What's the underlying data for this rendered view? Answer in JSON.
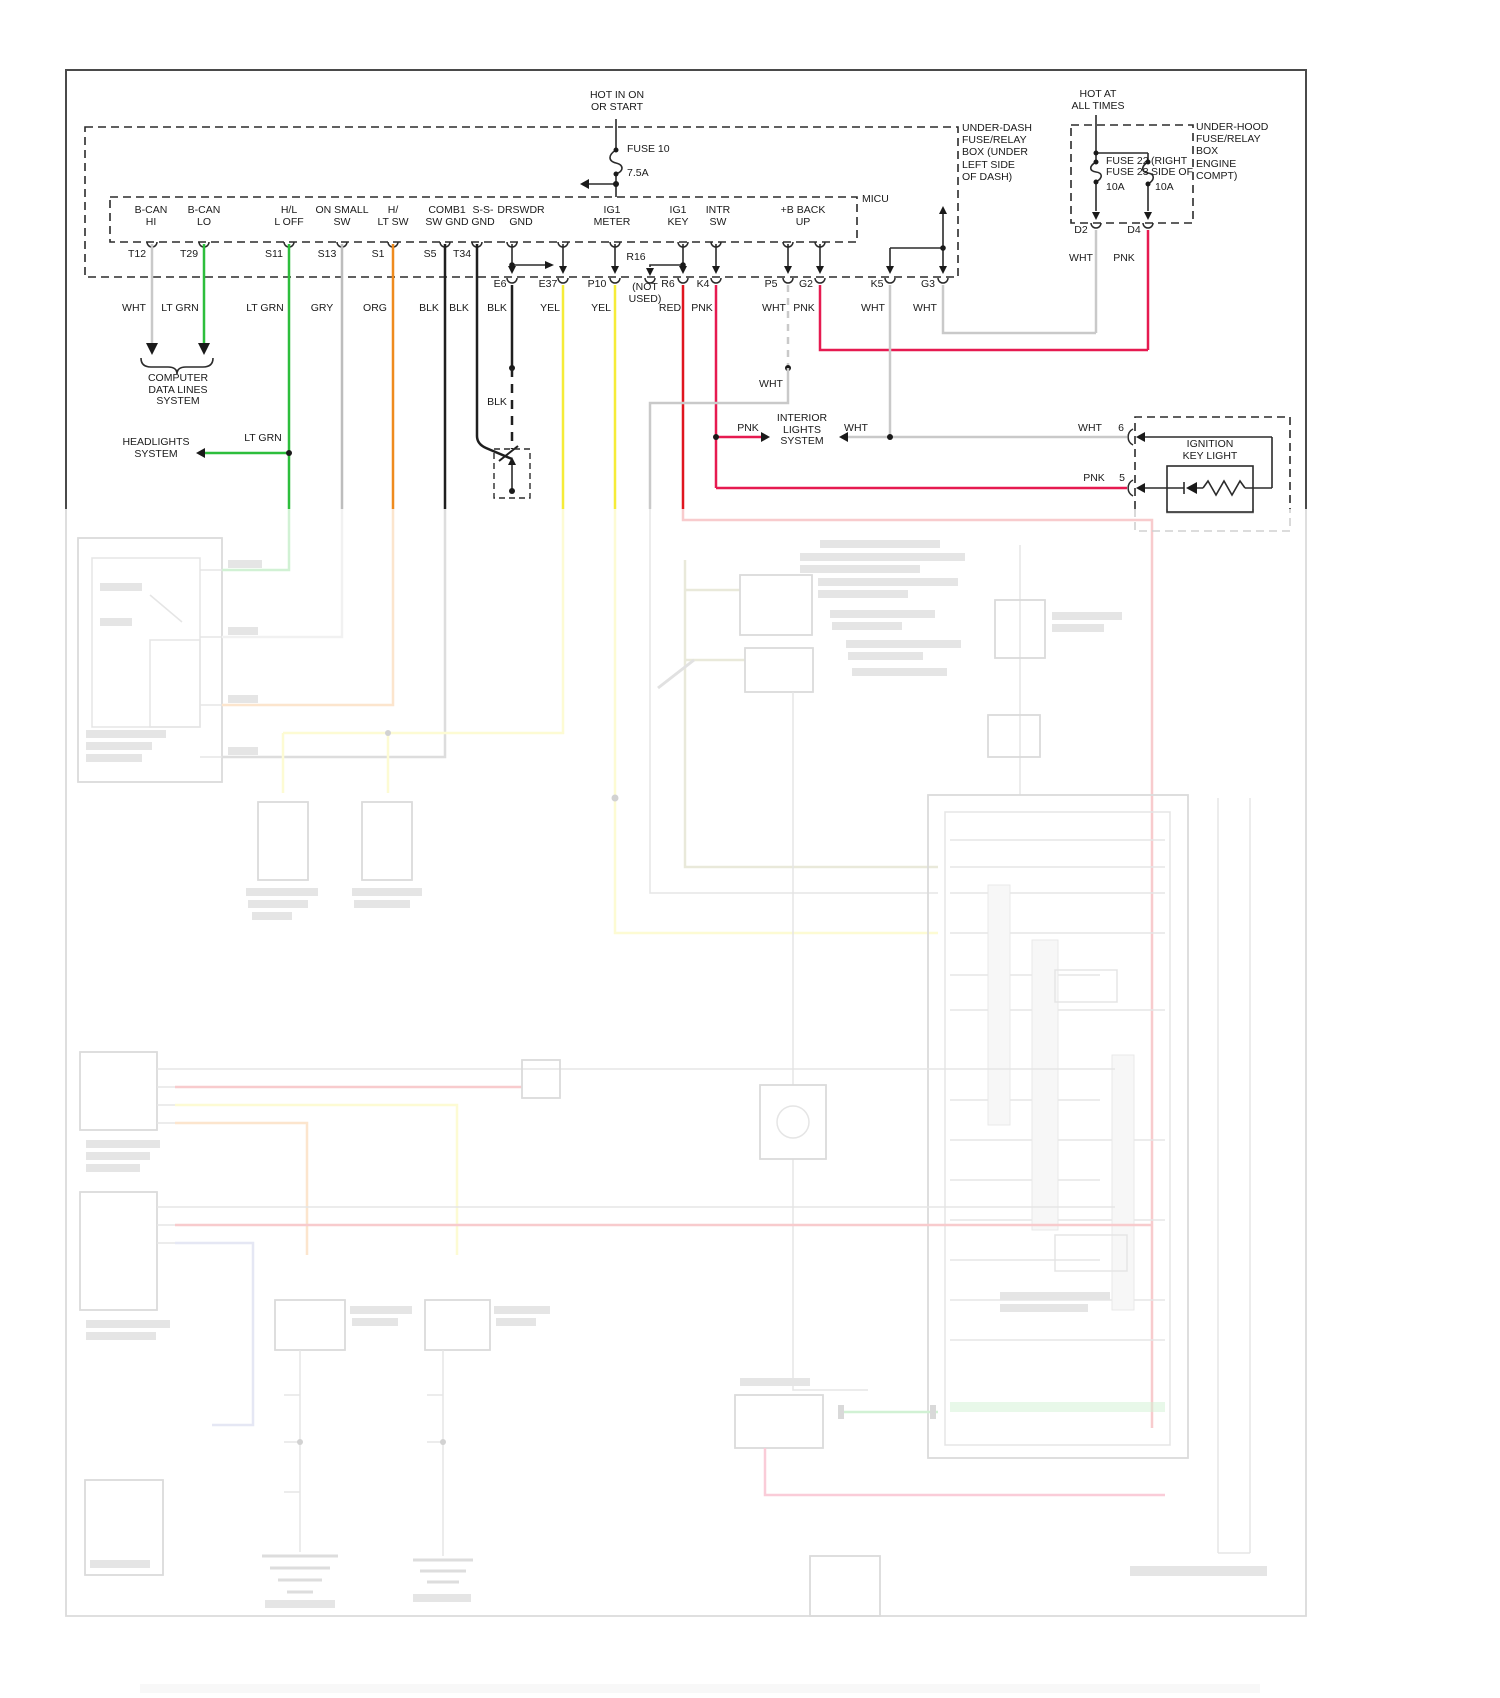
{
  "power": {
    "hot_in_on": "HOT IN ON\nOR START",
    "fuse10": "FUSE 10",
    "fuse10_amps": "7.5A",
    "hot_at": "HOT AT\nALL TIMES",
    "fuse22": "FUSE 22",
    "fuse23": "FUSE 23",
    "amps_a": "10A",
    "amps_b": "10A",
    "right_frag": "(RIGHT",
    "side_of_frag": "SIDE OF",
    "d2": "D2",
    "d4": "D4",
    "d2_color": "WHT",
    "d4_color": "PNK"
  },
  "boxes": {
    "underdash": "UNDER-DASH\nFUSE/RELAY\nBOX (UNDER\nLEFT SIDE\nOF DASH)",
    "underhood": "UNDER-HOOD\nFUSE/RELAY\nBOX\nENGINE\nCOMPT)"
  },
  "micu": {
    "label": "MICU",
    "signals": [
      "B-CAN\nHI",
      "B-CAN\nLO",
      "H/L\nL OFF",
      "ON SMALL\nSW",
      "H/\nLT SW",
      "COMB1\nSW GND",
      "S-S-\nGND",
      "DRSWDR\nGND",
      "IG1\nMETER",
      "IG1\nKEY",
      "INTR\nSW",
      "+B BACK\nUP"
    ],
    "terminals": [
      "T12",
      "T29",
      "S11",
      "S13",
      "S1",
      "S5",
      "T34"
    ],
    "connector_pins": [
      "E6",
      "E37",
      "P10",
      "R16",
      "R6",
      "K4",
      "P5",
      "G2",
      "K5",
      "G3"
    ],
    "wire_colors": [
      "WHT",
      "LT GRN",
      "LT GRN",
      "GRY",
      "ORG",
      "BLK",
      "BLK",
      "BLK",
      "YEL",
      "YEL",
      "RED",
      "PNK",
      "WHT",
      "PNK",
      "WHT",
      "WHT"
    ],
    "not_used": "(NOT\nUSED)",
    "ground_wire_color": "BLK"
  },
  "systems": {
    "computer": "COMPUTER\nDATA LINES\nSYSTEM",
    "headlights": "HEADLIGHTS\nSYSTEM",
    "headlights_color": "LT GRN",
    "interior": "INTERIOR\nLIGHTS\nSYSTEM",
    "interior_left_color": "PNK",
    "interior_right_color": "WHT",
    "p5_branch_color": "WHT"
  },
  "ignition": {
    "title": "IGNITION\nKEY LIGHT",
    "pin6": "6",
    "pin5": "5",
    "pin6_color": "WHT",
    "pin5_color": "PNK"
  },
  "colors": {
    "lt_grn": "#2dbe3c",
    "org": "#ef8b1e",
    "yel": "#f6ec38",
    "red": "#e0151f",
    "pnk": "#e61a50",
    "wht": "#c9c9c9",
    "gry": "#bdbdbd",
    "blk": "#1f1f1f",
    "olive": "#9a9a58",
    "blue": "#8890cc"
  }
}
